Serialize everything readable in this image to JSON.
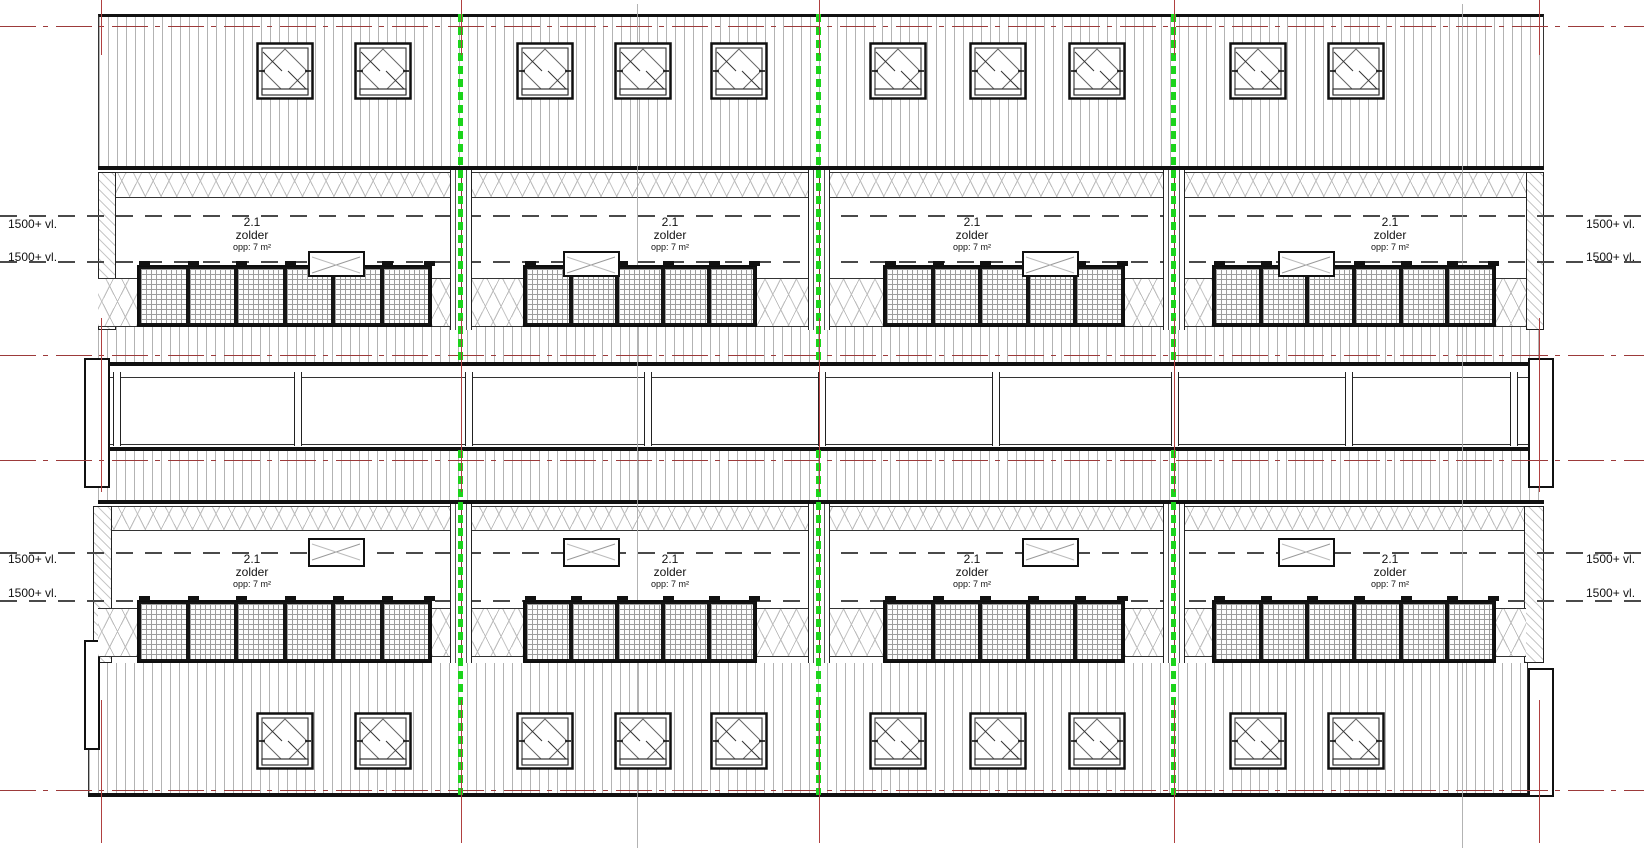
{
  "drawing": {
    "kind": "attic floor plan (verdieping 2 - zolder)",
    "level_marker_label": "1500+ vl."
  },
  "rooms": [
    {
      "number": "2.1",
      "name": "zolder",
      "area": "opp: 7 m²"
    },
    {
      "number": "2.1",
      "name": "zolder",
      "area": "opp: 7 m²"
    },
    {
      "number": "2.1",
      "name": "zolder",
      "area": "opp: 7 m²"
    },
    {
      "number": "2.1",
      "name": "zolder",
      "area": "opp: 7 m²"
    },
    {
      "number": "2.1",
      "name": "zolder",
      "area": "opp: 7 m²"
    },
    {
      "number": "2.1",
      "name": "zolder",
      "area": "opp: 7 m²"
    },
    {
      "number": "2.1",
      "name": "zolder",
      "area": "opp: 7 m²"
    },
    {
      "number": "2.1",
      "name": "zolder",
      "area": "opp: 7 m²"
    }
  ],
  "levels": {
    "label": "1500+ vl."
  },
  "colors": {
    "party_wall_marker_green": "#1bd41b",
    "grid_reference_red": "#9c3a3a",
    "hatch_gray": "#b3b3b3",
    "dashed_level_line_gray": "#4a4a4a"
  }
}
